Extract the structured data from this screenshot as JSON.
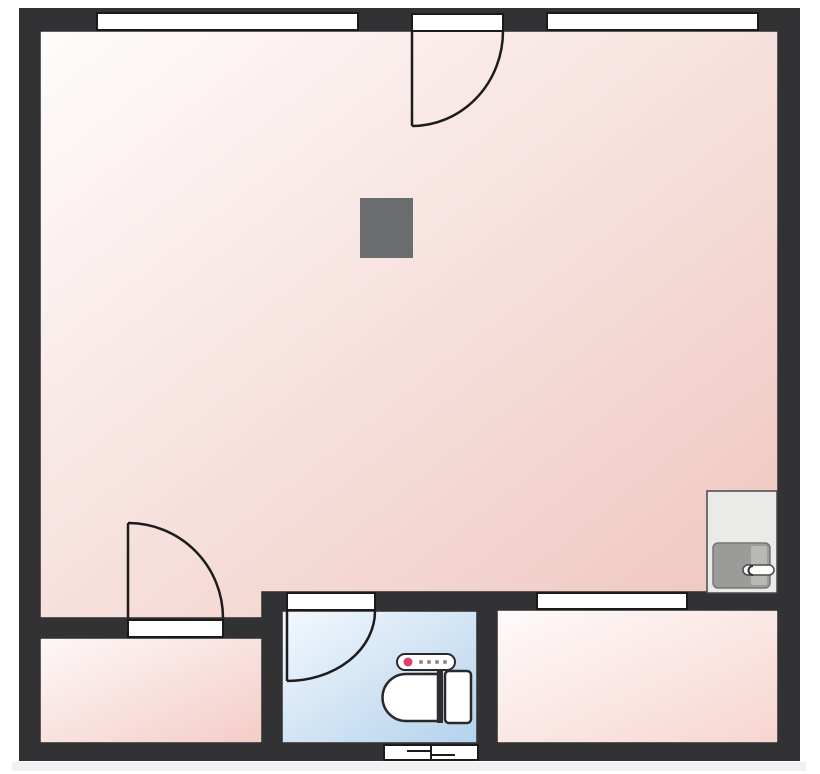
{
  "title": "Apartment floor plan",
  "colors": {
    "background": "#ffffff",
    "wall": "#323234",
    "opening_fill": "#ffffff",
    "opening_stroke": "#1a1a1c",
    "door_stroke": "#1c1c1e",
    "room_outline": "#2b2b2d",
    "column": "#6a6d6e",
    "shadow_strip": "#eff1f3",
    "fixture_fill": "#ffffff",
    "fixture_stroke": "#29292b"
  },
  "rooms": {
    "main": {
      "name": "main-room",
      "from": "#fefcfc",
      "to": "#efc5be"
    },
    "bottom_left": {
      "name": "bottom-left-room",
      "from": "#fdf8f8",
      "to": "#f4ccc7"
    },
    "bathroom": {
      "name": "bathroom",
      "from": "#f3f8fd",
      "to": "#b3d2ec"
    },
    "bottom_right": {
      "name": "bottom-right-room",
      "from": "#fefafa",
      "to": "#f7d5d0"
    }
  },
  "fixtures": {
    "toilet": {
      "bowl_fill": "#ffffff",
      "tank_fill": "#ffffff",
      "hinge_fill": "#2e2e30",
      "panel_fill": "#ffffff",
      "panel_dot": "#dd3f72",
      "panel_button": "#8d8d8b"
    },
    "appliance": {
      "body": "#eaeae8",
      "body_stroke": "#48484a",
      "door": "#9b9b99",
      "door_stroke": "#767674",
      "door_light": "#b8b8b6",
      "handle": "#fcfcfa",
      "handle_stroke": "#4a4a48"
    }
  },
  "counts": {
    "windows_top_wall": "2",
    "interior_doors": "3",
    "vents": "1"
  }
}
